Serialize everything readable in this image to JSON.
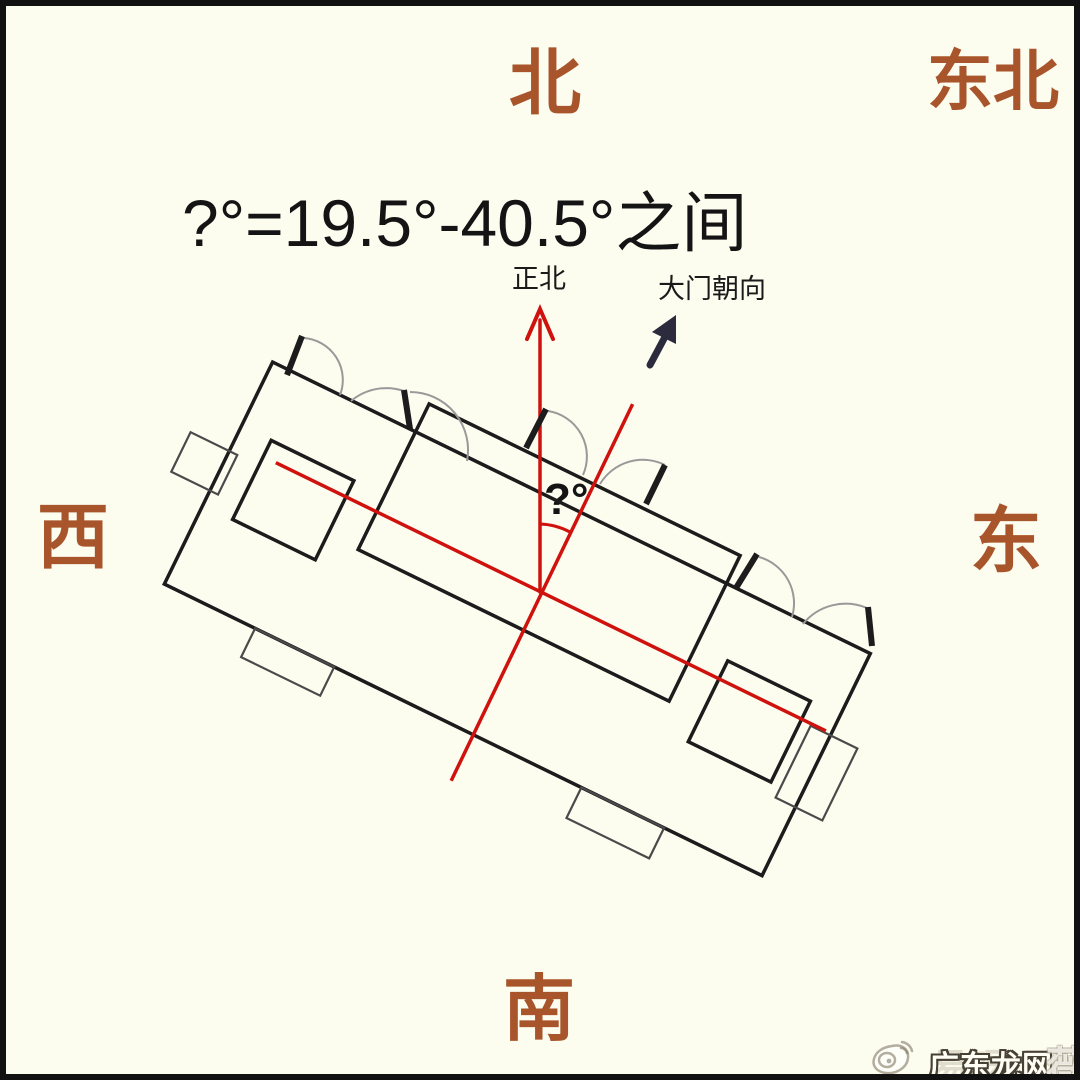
{
  "compass": {
    "north": "北",
    "northeast": "东北",
    "west": "西",
    "east": "东",
    "south": "南"
  },
  "formula": {
    "text": "?°=19.5°-40.5°之间"
  },
  "annotations": {
    "true_north_label": "正北",
    "gate_direction_label": "大门朝向",
    "angle_label": "?°"
  },
  "watermark": {
    "icon": "weibo-icon",
    "main_text": "广东龙网",
    "ghost_text_left": "易呀",
    "ghost_text_right": "薇"
  },
  "colors": {
    "background": "#fcfcef",
    "frame_border": "#111111",
    "compass_text": "#a9552b",
    "formula_text": "#141414",
    "building_outline": "#1c1c1c",
    "balcony_stroke": "#4a4a4a",
    "door_arc_gray": "#999999",
    "axis_red": "#d0120e",
    "gate_arrow_navy": "#2b2b3d"
  }
}
